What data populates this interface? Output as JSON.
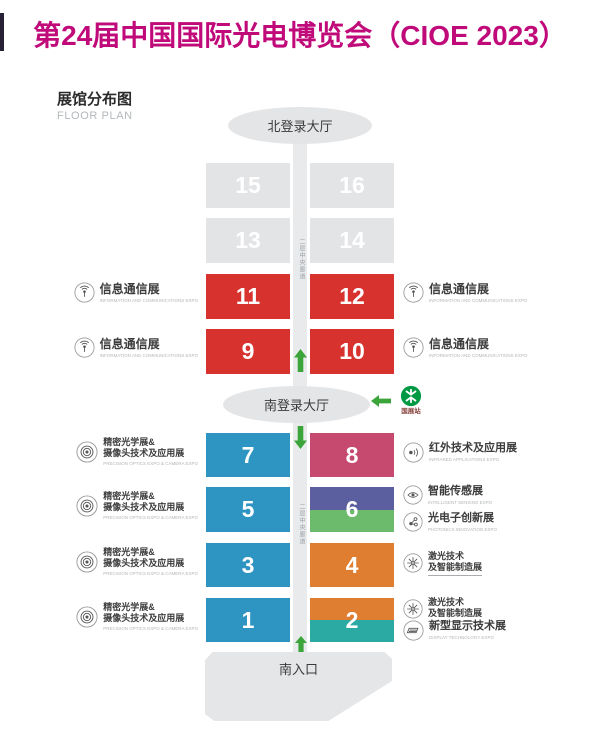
{
  "title": "第24届中国国际光电博览会（CIOE 2023）",
  "heading": {
    "zh": "展馆分布图",
    "en": "FLOOR PLAN"
  },
  "map": {
    "north_hall": "北登录大厅",
    "south_hall": "南登录大厅",
    "south_entrance": "南入口",
    "corridor_upper": "二层中央廊道",
    "corridor_lower": "二层中央廊道",
    "metro_station": "国展站"
  },
  "halls": {
    "h1": {
      "no": "1",
      "bg": "#2E94C1"
    },
    "h2": {
      "no": "2",
      "bg_top": "#DF7D30",
      "bg_bottom": "#2BA9A3"
    },
    "h3": {
      "no": "3",
      "bg": "#2E94C1"
    },
    "h4": {
      "no": "4",
      "bg": "#DF7D30"
    },
    "h5": {
      "no": "5",
      "bg": "#2E94C1"
    },
    "h6": {
      "no": "6",
      "bg_top": "#5C5F9F",
      "bg_bottom": "#6CBB6C"
    },
    "h7": {
      "no": "7",
      "bg": "#2E94C1"
    },
    "h8": {
      "no": "8",
      "bg": "#C6496F"
    },
    "h9": {
      "no": "9",
      "bg": "#D7322E"
    },
    "h10": {
      "no": "10",
      "bg": "#D7322E"
    },
    "h11": {
      "no": "11",
      "bg": "#D7322E"
    },
    "h12": {
      "no": "12",
      "bg": "#D7322E"
    },
    "h13": {
      "no": "13",
      "bg": "#E3E4E6"
    },
    "h14": {
      "no": "14",
      "bg": "#E3E4E6"
    },
    "h15": {
      "no": "15",
      "bg": "#E3E4E6"
    },
    "h16": {
      "no": "16",
      "bg": "#E3E4E6"
    }
  },
  "labels": {
    "info_comm": {
      "zh": "信息通信展",
      "en": "INFORMATION AND COMMUNICATIONS EXPO"
    },
    "optics": {
      "zh1": "精密光学展&",
      "zh2": "摄像头技术及应用展",
      "en": "PRECISION OPTICS EXPO & CAMERA EXPO"
    },
    "infrared": {
      "zh": "红外技术及应用展",
      "en": "INFRARED APPLICATIONS EXPO"
    },
    "sensing": {
      "zh": "智能传感展",
      "en": "INTELLIGENT SENSING EXPO"
    },
    "photonics": {
      "zh": "光电子创新展",
      "en": "PHOTONICS INNOVATION EXPO"
    },
    "laser": {
      "zh1": "激光技术",
      "zh2": "及智能制造展"
    },
    "display": {
      "zh": "新型显示技术展",
      "en": "DISPLAY TECHNOLOGY EXPO"
    }
  },
  "colors": {
    "title": "#C00A7A",
    "edge": "#262135",
    "arrow_green": "#3BA43B",
    "metro_green": "#009943",
    "hall_gray": "#E3E4E6",
    "corridor_gray": "#E9EAEB"
  }
}
